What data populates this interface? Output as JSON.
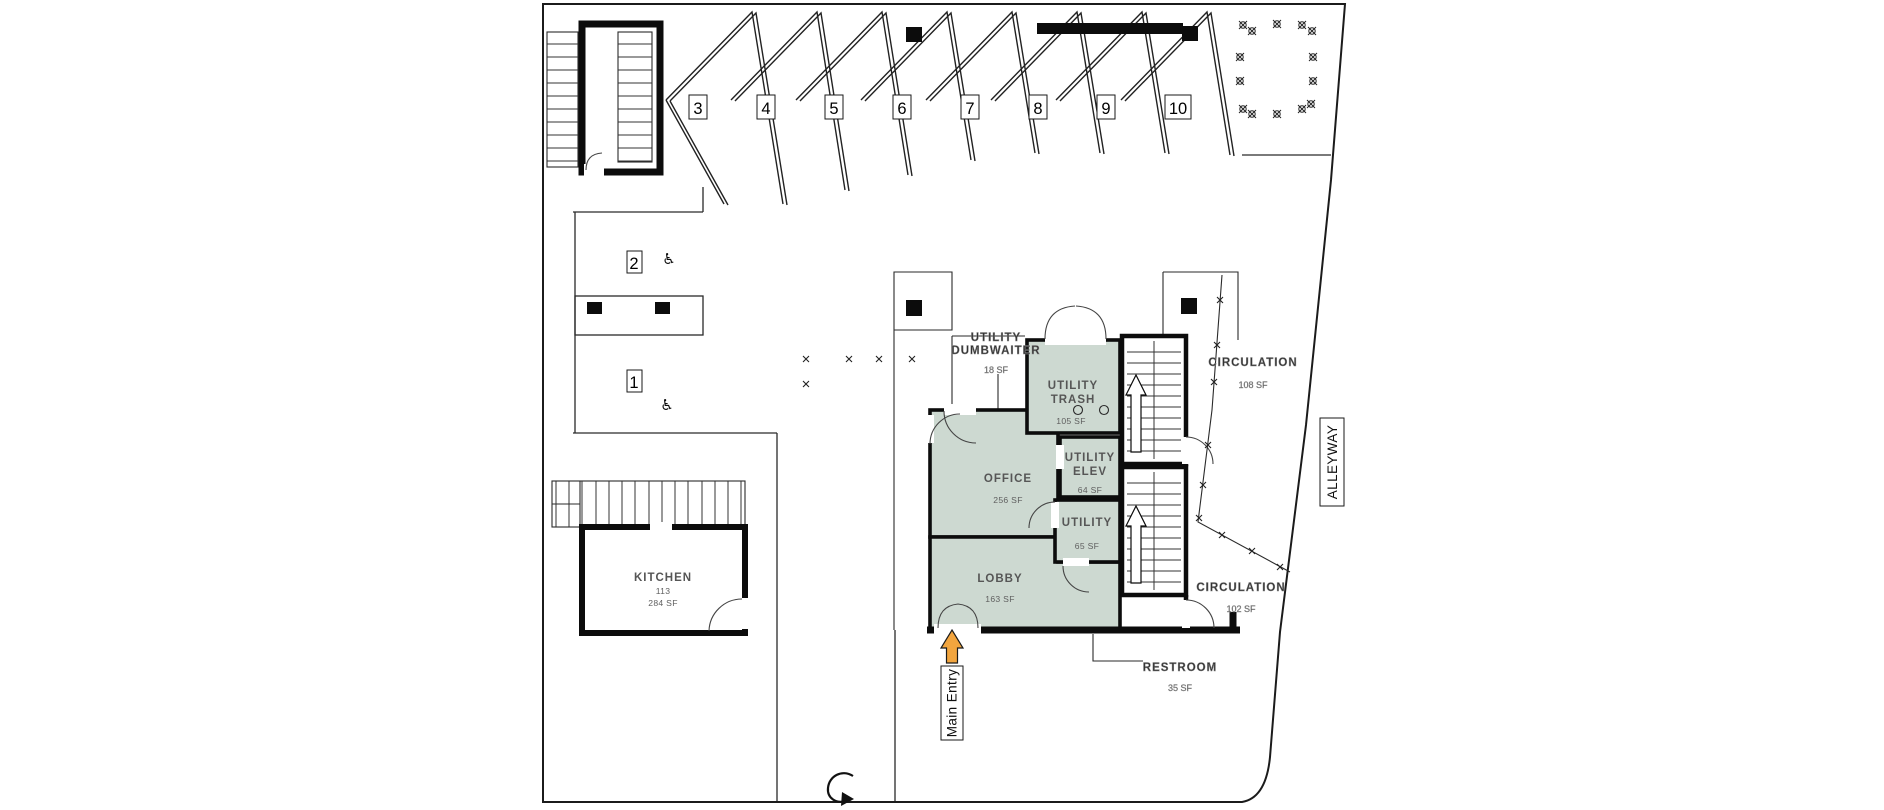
{
  "colors": {
    "room_fill": "#cdd9d1",
    "kitchen_fill": "#ffffff",
    "wall": "#0c0c0c",
    "arrow_orange": "#f2a53e",
    "label_gray": "#565656"
  },
  "parking": {
    "stalls": [
      "1",
      "2",
      "3",
      "4",
      "5",
      "6",
      "7",
      "8",
      "9",
      "10"
    ],
    "accessible_stalls": [
      "1",
      "2"
    ]
  },
  "rooms": {
    "office": {
      "name": "OFFICE",
      "area": "256 SF"
    },
    "lobby": {
      "name": "LOBBY",
      "area": "163 SF"
    },
    "utility_trash": {
      "name_line1": "UTILITY",
      "name_line2": "TRASH",
      "area": "105 SF"
    },
    "utility_elev": {
      "name_line1": "UTILITY",
      "name_line2": "ELEV",
      "area": "64 SF"
    },
    "utility": {
      "name": "UTILITY",
      "area": "65 SF"
    },
    "kitchen": {
      "name": "KITCHEN",
      "number": "113",
      "area": "284 SF"
    }
  },
  "annotations": {
    "dumbwaiter": {
      "line1": "UTILITY",
      "line2": "DUMBWAITER",
      "area": "18 SF"
    },
    "circulation_upper": {
      "name": "CIRCULATION",
      "area": "108 SF"
    },
    "circulation_lower": {
      "name": "CIRCULATION",
      "area": "102 SF"
    },
    "restroom": {
      "name": "RESTROOM",
      "area": "35 SF"
    },
    "alleyway": "ALLEYWAY",
    "main_entry": "Main Entry"
  }
}
